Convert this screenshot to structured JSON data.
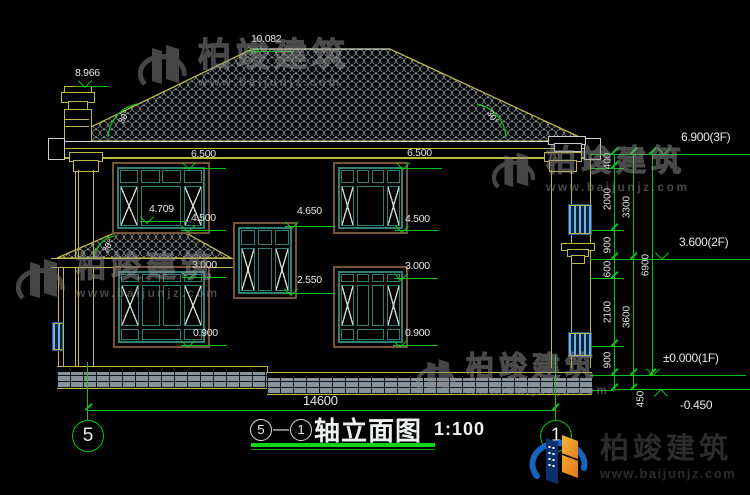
{
  "drawing": {
    "title_text": "轴立面图",
    "title_scale": "1:100",
    "title_axis_start": "5",
    "title_axis_sep": "—",
    "title_axis_end": "1",
    "axis_left_bubble": "5",
    "axis_right_bubble": "1"
  },
  "levels": {
    "chimney": "8.966",
    "ridge": "10.082",
    "eave_left": "6.500",
    "eave_right": "6.500",
    "porch_ridge": "4.709",
    "window2f_sill_left": "4.500",
    "stair_window_top": "4.650",
    "window2f_sill_right": "4.500",
    "window1f_top_left": "3.000",
    "stair_window_sill": "2.550",
    "window1f_top_right": "3.000",
    "window1f_sill_left": "0.900",
    "window1f_sill_right": "0.900",
    "floor3": "6.900(3F)",
    "floor2": "3.600(2F)",
    "floor1": "±0.000(1F)",
    "ground": "-0.450"
  },
  "dimensions": {
    "seg400": "400",
    "seg2000": "2000",
    "seg900a": "900",
    "seg600": "600",
    "seg2100": "2100",
    "seg900b": "900",
    "seg450": "450",
    "story_upper": "3300",
    "story_lower": "3600",
    "total_height": "6900",
    "total_width": "14600"
  },
  "angles": {
    "main_left": "30°",
    "main_right": "30°",
    "porch": "30°"
  },
  "watermark": {
    "name": "柏竣建筑",
    "url": "www.baijunjz.com"
  },
  "logo": {
    "name": "柏竣建筑",
    "url": "www.baijunjz.com"
  }
}
